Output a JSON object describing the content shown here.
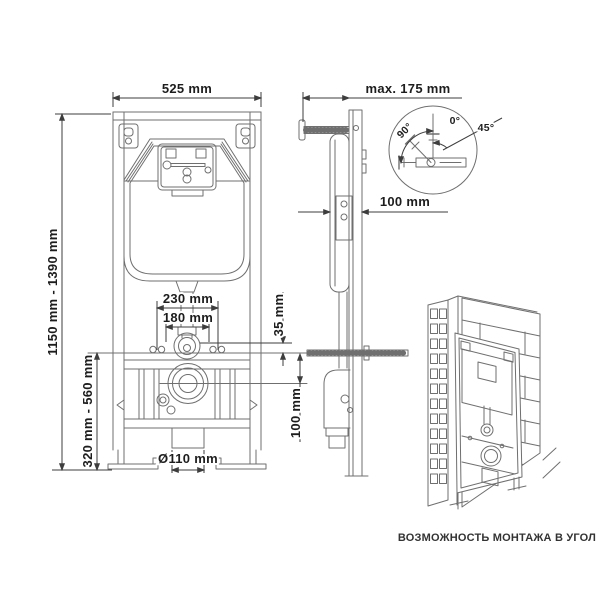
{
  "meta": {
    "background": "#ffffff",
    "drawing_line_color": "#6f6f6f",
    "dimension_line_color": "#3d3d3d",
    "text_color": "#1d1d1d",
    "subject": "concealed WC cistern installation frame, technical drawing with three views"
  },
  "front_view": {
    "label": "front view",
    "dims": {
      "width": "525 mm",
      "height_range": "1150 mm - 1390 mm",
      "lower_height_range": "320 mm - 560 mm",
      "bracket_width": "230 mm",
      "inner_width": "180 mm",
      "flush_offset": "35 mm",
      "plate_to_outlet": "100 mm",
      "drain_diameter": "Ø110 mm"
    }
  },
  "side_view": {
    "label": "side view",
    "dims": {
      "wall_distance": "max. 175 mm",
      "depth": "100 mm"
    },
    "detail": {
      "swivel_angle": "90°",
      "tilt_from": "0°",
      "tilt_to": "45°"
    }
  },
  "corner_view": {
    "label": "corner installation view",
    "caption": "ВОЗМОЖНОСТЬ МОНТАЖА В УГОЛ"
  }
}
